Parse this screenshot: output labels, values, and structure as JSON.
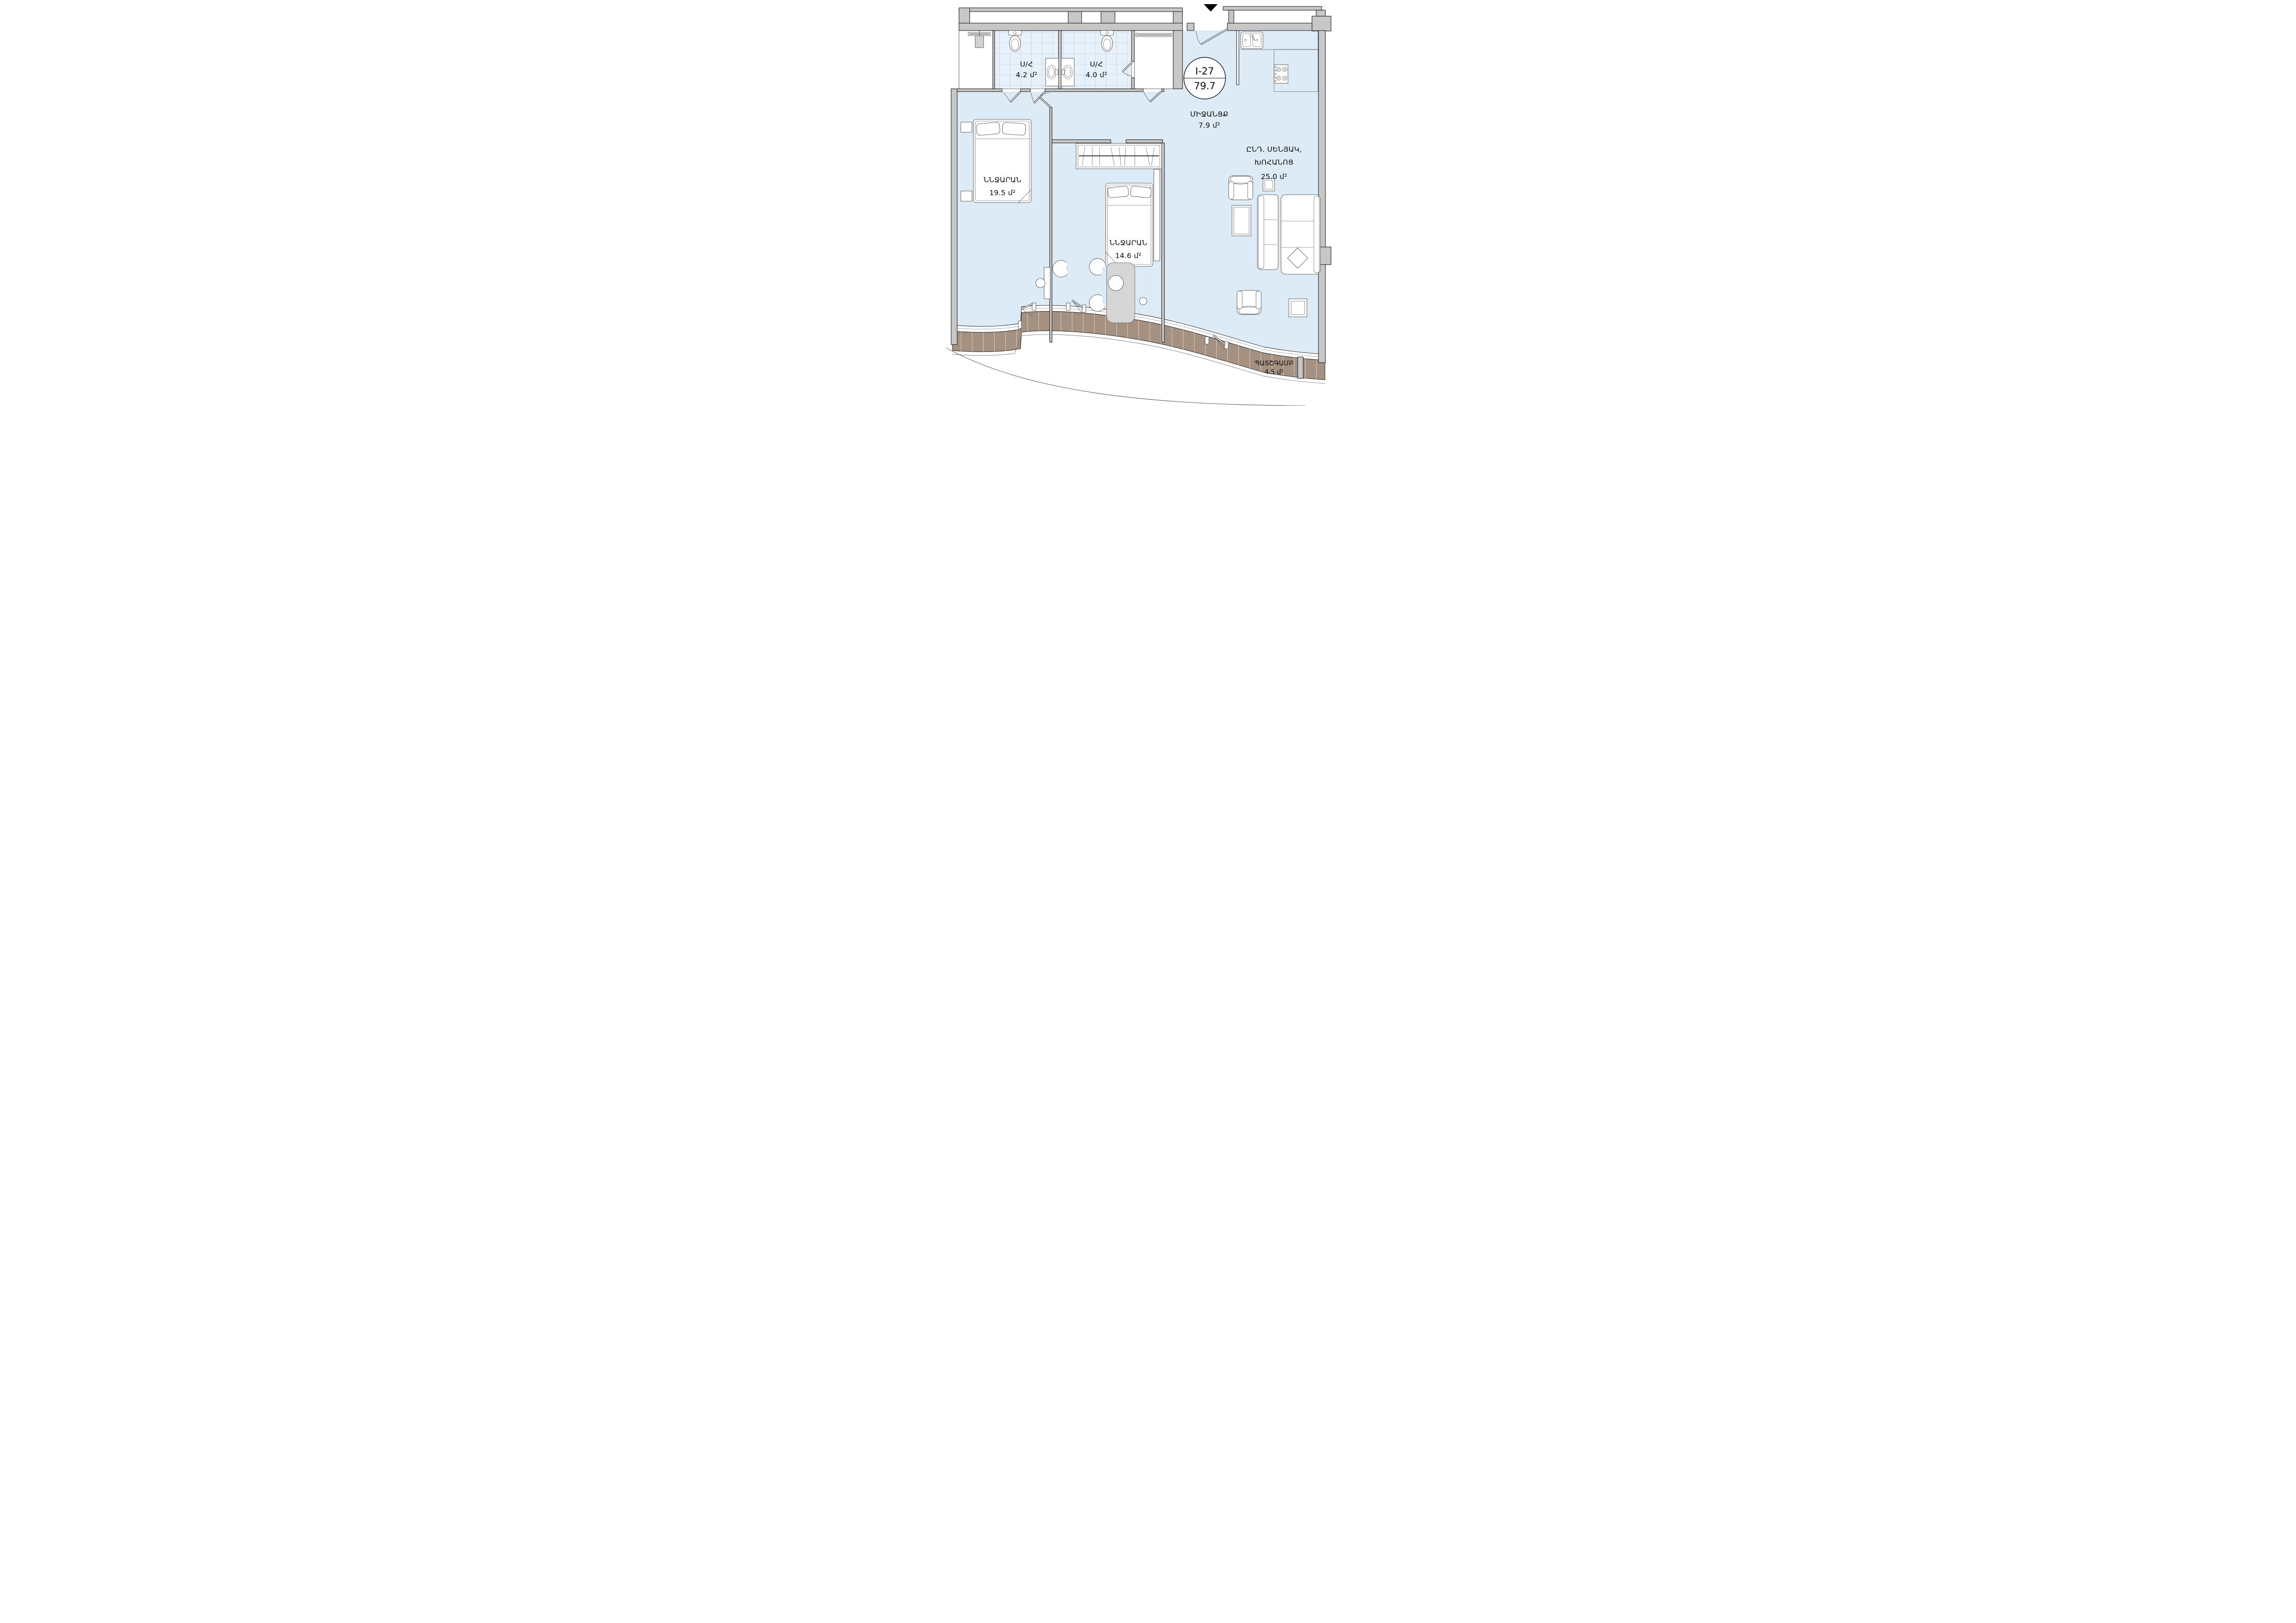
{
  "plan": {
    "title": "apartment-floor-plan",
    "entrance_marker": "down-triangle",
    "unit_badge": {
      "unit": "I-27",
      "total_area": "79.7"
    },
    "rooms": {
      "bathroom_1": {
        "name": "Ս/Հ",
        "area": "4.2 մ²"
      },
      "bathroom_2": {
        "name": "Ս/Հ",
        "area": "4.0 մ²"
      },
      "hallway": {
        "name": "ՄԻՋԱՆՑՔ",
        "area": "7.9 մ²"
      },
      "living_kitchen": {
        "name_line1": "ԸՆԴ. ՍԵՆՅԱԿ,",
        "name_line2": "ԽՈՀԱՆՈՑ",
        "area": "25.0 մ²"
      },
      "bedroom_1": {
        "name": "ՆՆՋԱՐԱՆ",
        "area": "19.5 մ²"
      },
      "bedroom_2": {
        "name": "ՆՆՋԱՐԱՆ",
        "area": "14.6 մ²"
      },
      "balcony": {
        "name": "ՊԱՏՇԳԱՄԲ",
        "area": "4.5 մ²"
      }
    },
    "colors": {
      "wall": "#c7c7c8",
      "floor": "#dcebf5",
      "bath_tile": "#e7f1f9",
      "balcony_deck": "#a49181",
      "outline": "#1a1a1a"
    }
  }
}
